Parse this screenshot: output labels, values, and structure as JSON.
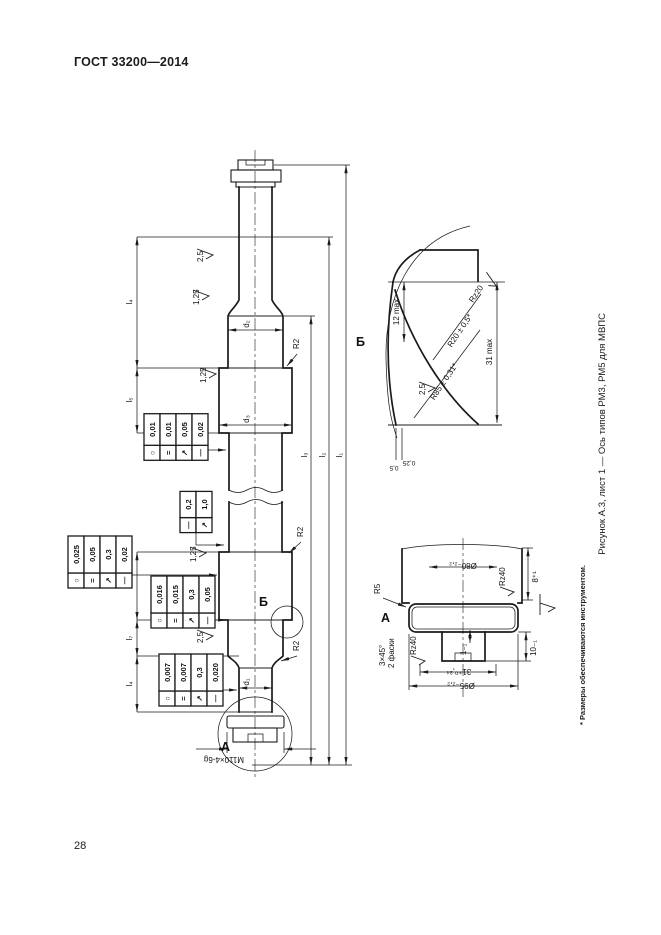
{
  "page": {
    "header": "ГОСТ 33200—2014",
    "page_number": "28",
    "caption": "Рисунок А.3, лист 1 — Ось типов РМ3, РМ5 для МВПС",
    "footnote": "* Размеры обеспечиваются инструментом."
  },
  "drawing": {
    "thread_label": "М110×4-6g",
    "callouts": {
      "a": "А",
      "b": "Б"
    },
    "length_labels": {
      "l1": "l₁",
      "l2": "l₂",
      "l3": "l₃",
      "l4_top": "l₄",
      "l5": "l₅",
      "l6": "l₆",
      "l7": "l₇",
      "l4_bottom": "l₄"
    },
    "diameter_labels": {
      "d1": "d₁",
      "d2": "d₂",
      "d3": "d₃"
    },
    "radius_label": "R2",
    "roughness": {
      "v25": "2,5",
      "v125": "1,25",
      "rz20": "Rz20",
      "rz40": "Rz40"
    },
    "frames": [
      {
        "name": "tolerance-frame-wheel-seat-1",
        "rows": [
          [
            "○",
            "0,01"
          ],
          [
            "=",
            "0,01"
          ],
          [
            "↗",
            "0,05"
          ],
          [
            "—",
            "0,02"
          ]
        ]
      },
      {
        "name": "tolerance-frame-middle-part",
        "rows": [
          [
            "—",
            "0,2"
          ],
          [
            "↗",
            "1,0"
          ]
        ]
      },
      {
        "name": "tolerance-frame-wheel-seat-2a",
        "rows": [
          [
            "○",
            "0,025"
          ],
          [
            "=",
            "0,05"
          ],
          [
            "↗",
            "0,3"
          ],
          [
            "—",
            "0,02"
          ]
        ]
      },
      {
        "name": "tolerance-frame-wheel-seat-2b",
        "rows": [
          [
            "○",
            "0,016"
          ],
          [
            "=",
            "0,015"
          ],
          [
            "↗",
            "0,3"
          ],
          [
            "—",
            "0,05"
          ]
        ]
      },
      {
        "name": "tolerance-frame-journal",
        "rows": [
          [
            "○",
            "0,007"
          ],
          [
            "=",
            "0,007"
          ],
          [
            "↗",
            "0,3"
          ],
          [
            "—",
            "0,020"
          ]
        ]
      }
    ],
    "detail_b": {
      "dim_depth": "12 max",
      "dim_length": "31 max",
      "radius_large": "R85 ± 0,31*",
      "radius_small": "R20 ± 0,5*",
      "edge_1": "0,25",
      "edge_2": "0,5"
    },
    "detail_a": {
      "dia_groove": "Ø80₋₂,₂",
      "dia_thread": "Ø95₋₂,₂",
      "len_thread": "31⁺⁰,³⁴",
      "len_8": "8⁺¹",
      "len_10": "10₋₁",
      "len_1": "1₋₁",
      "chamfer": "3×45°",
      "chamfer_note": "2 фаски",
      "radius": "R5"
    }
  }
}
